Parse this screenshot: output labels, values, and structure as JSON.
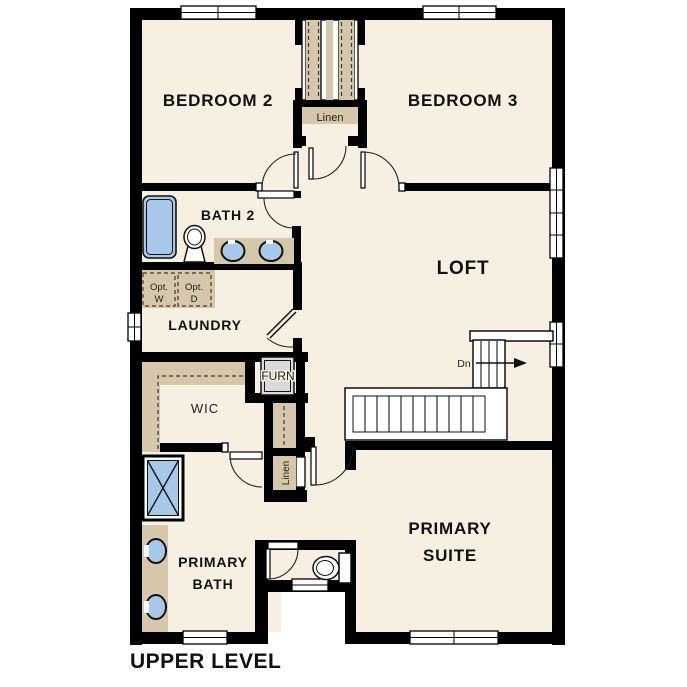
{
  "title": "UPPER LEVEL",
  "colors": {
    "floor": "#f7efe2",
    "wall": "#000000",
    "millwork": "#d6c7aa",
    "fixture_blue": "#a7c8e9",
    "furnace_gray": "#dadada"
  },
  "rooms": {
    "bedroom2": {
      "label": "BEDROOM 2"
    },
    "bedroom3": {
      "label": "BEDROOM 3"
    },
    "loft": {
      "label": "LOFT"
    },
    "bath2": {
      "label": "BATH 2"
    },
    "laundry": {
      "label": "LAUNDRY"
    },
    "wic": {
      "label": "WIC"
    },
    "primary_bath": {
      "label_line1": "PRIMARY",
      "label_line2": "BATH"
    },
    "primary_suite": {
      "label_line1": "PRIMARY",
      "label_line2": "SUITE"
    }
  },
  "closets": {
    "hall_linen": {
      "label": "Linen"
    },
    "lower_linen": {
      "label": "Linen"
    },
    "furnace": {
      "label": "FURN"
    }
  },
  "laundry_options": {
    "washer": {
      "line1": "Opt.",
      "line2": "W"
    },
    "dryer": {
      "line1": "Opt.",
      "line2": "D"
    }
  },
  "stairs": {
    "direction_label": "Dn"
  }
}
